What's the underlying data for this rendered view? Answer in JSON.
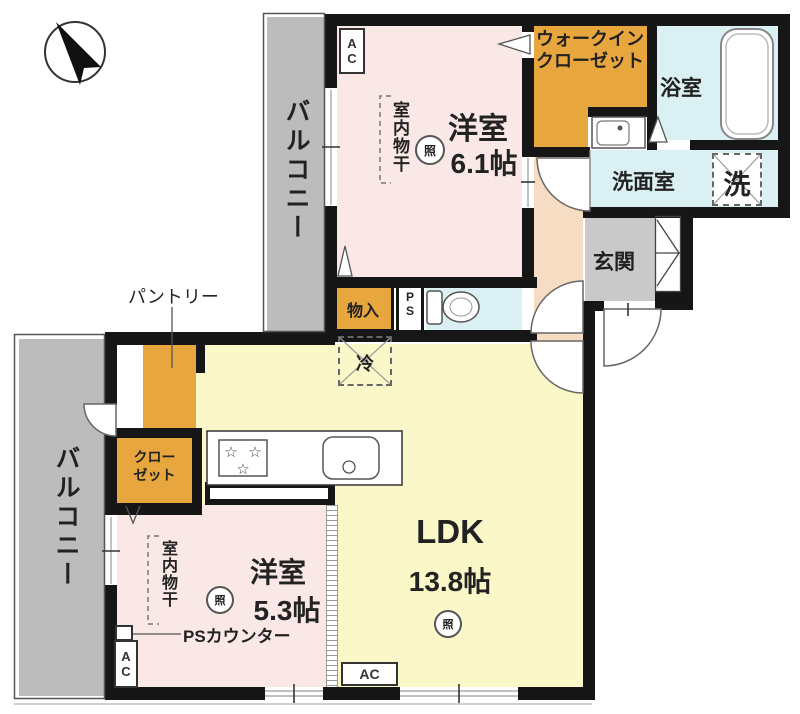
{
  "colors": {
    "wall": "#161616",
    "balcony": "#bcbcbc",
    "pink": "#fae8e6",
    "yellow": "#faf7c9",
    "orange": "#e7a63e",
    "cyan": "#daf0f2",
    "peach": "#f6dcc2",
    "gray": "#c9c9c9",
    "outline": "#555555",
    "text": "#222222"
  },
  "compass": {
    "icon": "north-arrow"
  },
  "balcony_upper": {
    "label": "バルコニー"
  },
  "balcony_lower": {
    "label": "バルコニー"
  },
  "bedroom1": {
    "name": "洋室",
    "size": "6.1帖",
    "drying_label": "室内物干",
    "light": "照",
    "ac": "AC"
  },
  "walk_in_closet": {
    "label": "ウォークイン\nクローゼット"
  },
  "bathroom": {
    "label": "浴室"
  },
  "washroom": {
    "label": "洗面室",
    "washer": "洗"
  },
  "entrance": {
    "label": "玄関"
  },
  "storage": {
    "label": "物入"
  },
  "pipe_space": {
    "label": "PS"
  },
  "ldk": {
    "name": "LDK",
    "size": "13.8帖",
    "light": "照",
    "ac": "AC",
    "fridge": "冷",
    "pantry_label": "パントリー"
  },
  "closet": {
    "label": "クロー\nゼット"
  },
  "bedroom2": {
    "name": "洋室",
    "size": "5.3帖",
    "drying_label": "室内物干",
    "light": "照",
    "ac": "AC",
    "counter_label": "PSカウンター"
  }
}
